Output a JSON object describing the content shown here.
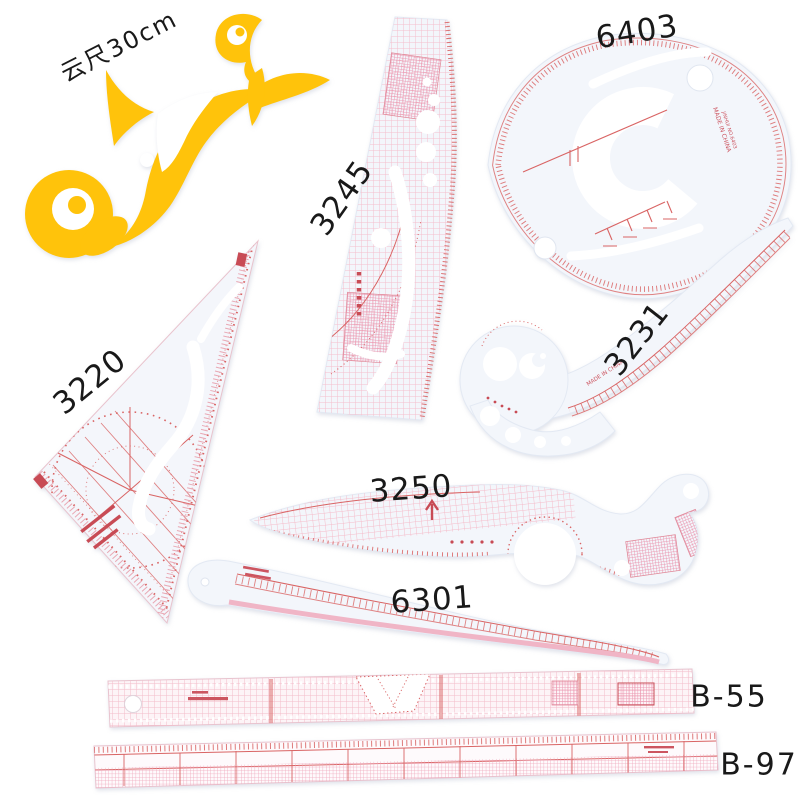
{
  "colors": {
    "background": "#ffffff",
    "yellow": "#ffc30b",
    "marking_red": "#d96464",
    "stamp_red": "#c84b55",
    "pink_grid": "#f2b4c4",
    "plastic_body": "#f3f6fb",
    "label_black": "#191919"
  },
  "items": [
    {
      "id": "cloud-curve-ruler",
      "label": "云尺30cm"
    },
    {
      "id": "teardrop-ruler",
      "label": "6403",
      "made_in": "MADE IN CHINA",
      "model_text": "JINHUI NO.6403"
    },
    {
      "id": "grading-ruler",
      "label": "3245"
    },
    {
      "id": "triangle-ruler",
      "label": "3220"
    },
    {
      "id": "french-curve-ruler",
      "label": "3231",
      "made_in": "MADE IN CHINA"
    },
    {
      "id": "curve-comb-ruler",
      "label": "3250"
    },
    {
      "id": "hip-curve-ruler",
      "label": "6301"
    },
    {
      "id": "grid-ruler",
      "label": "B-55"
    },
    {
      "id": "gradation-ruler",
      "label": "B-97"
    }
  ]
}
